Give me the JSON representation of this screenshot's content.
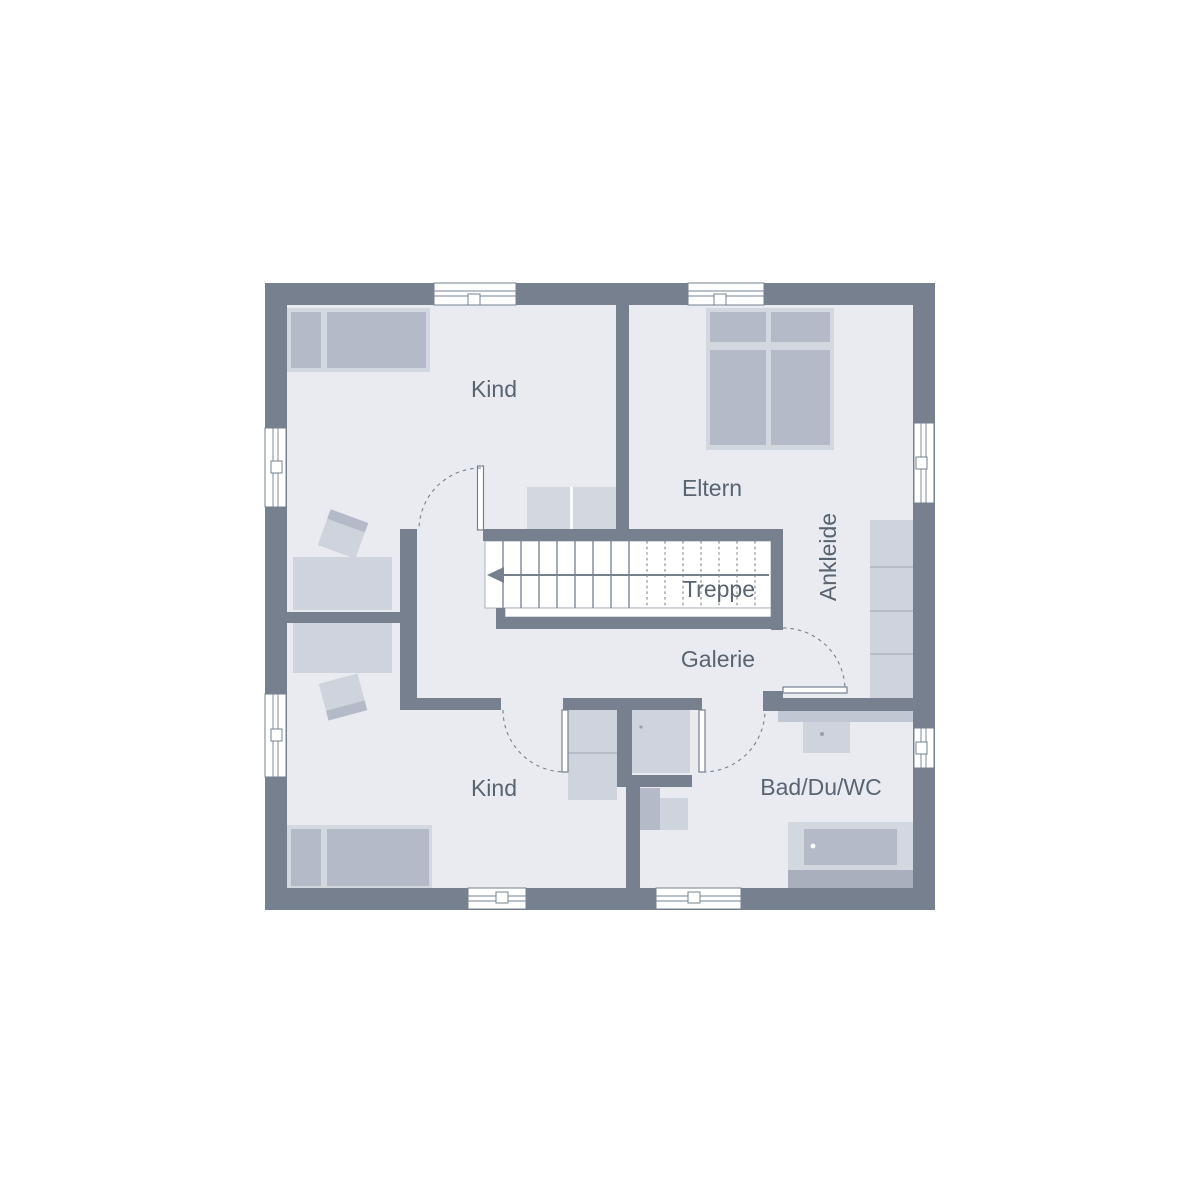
{
  "plan": {
    "rooms": [
      {
        "id": "kind-top",
        "label": "Kind"
      },
      {
        "id": "eltern",
        "label": "Eltern"
      },
      {
        "id": "ankleide",
        "label": "Ankleide"
      },
      {
        "id": "treppe",
        "label": "Treppe"
      },
      {
        "id": "galerie",
        "label": "Galerie"
      },
      {
        "id": "kind-bottom",
        "label": "Kind"
      },
      {
        "id": "bad",
        "label": "Bad/Du/WC"
      }
    ],
    "colors": {
      "wall": "#76808F",
      "floor": "#E9EBF1",
      "furniture": "#B4BAC7",
      "furniture_light": "#D3D7E0",
      "furniture_mid": "#CED3DD",
      "furniture_deep": "#A9AFBC",
      "stair_line": "#7E8795",
      "divider": "#ADB4C1",
      "label_text": "#5A6370"
    }
  }
}
